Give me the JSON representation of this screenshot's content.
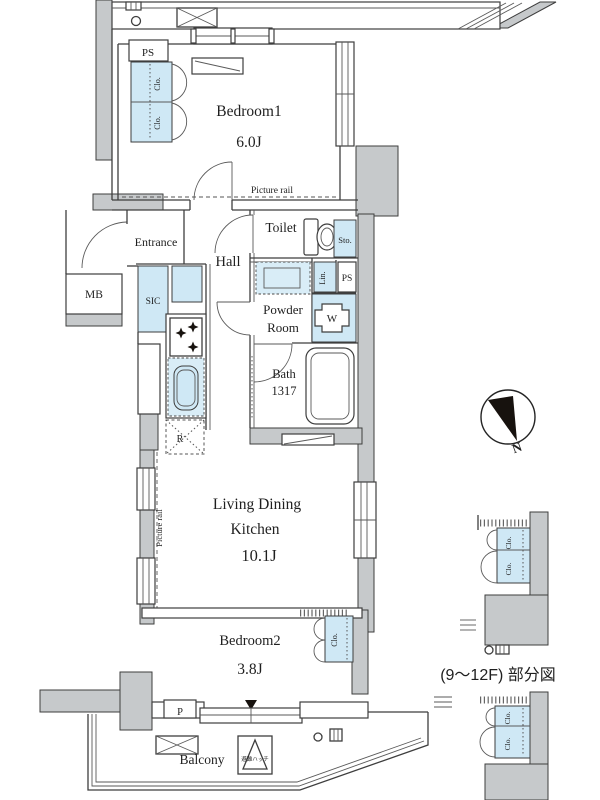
{
  "floor_plan": {
    "rooms": {
      "bedroom1": {
        "name": "Bedroom1",
        "size": "6.0J"
      },
      "bedroom2": {
        "name": "Bedroom2",
        "size": "3.8J"
      },
      "living_dining_kitchen": {
        "name_line1": "Living Dining",
        "name_line2": "Kitchen",
        "size": "10.1J"
      },
      "toilet": {
        "name": "Toilet"
      },
      "hall": {
        "name": "Hall"
      },
      "entrance": {
        "name": "Entrance"
      },
      "powder_room": {
        "name_line1": "Powder",
        "name_line2": "Room"
      },
      "bath": {
        "name": "Bath",
        "size": "1317"
      },
      "balcony": {
        "name": "Balcony"
      }
    },
    "fixtures": {
      "ps_label": "PS",
      "mb_label": "MB",
      "sic_label": "SIC",
      "sto_label": "Sto.",
      "lin_label": "Lin.",
      "washer_label": "W",
      "fridge_label": "R",
      "pipe_label": "P",
      "closet_label": "Clo.",
      "evacuation_hatch_label": "避難ハッチ"
    },
    "annotations": {
      "picture_rail": "Picture rail",
      "caption": "(9〜12F) 部分図",
      "compass_north": "N"
    },
    "colors": {
      "wall_fill": "#c6c9cb",
      "fixture_fill": "#cfe8f5",
      "line": "#3e3e3e",
      "compass_needle": "#17120e"
    }
  }
}
